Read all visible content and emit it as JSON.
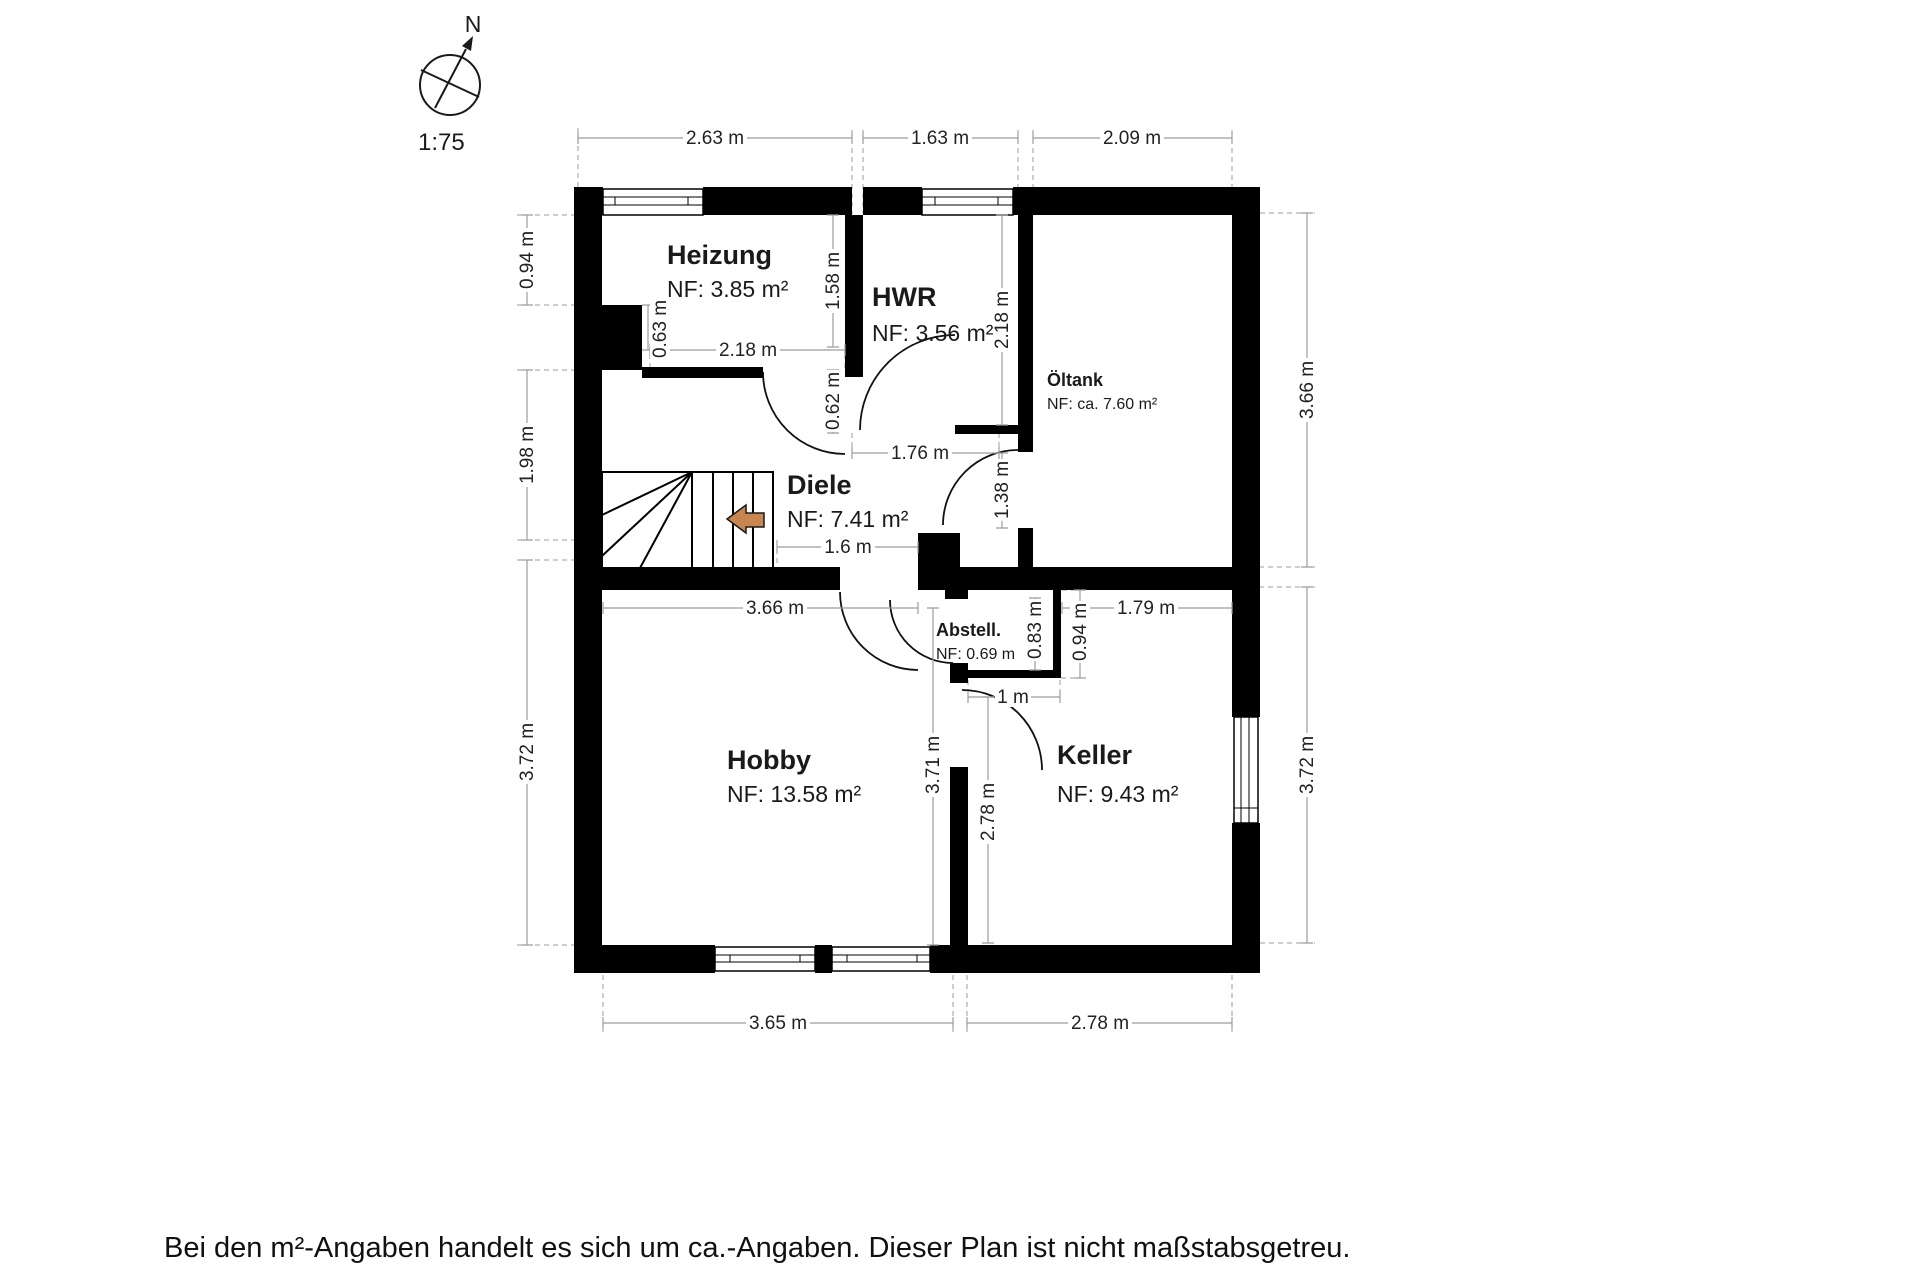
{
  "compass": {
    "north": "N",
    "scale": "1:75"
  },
  "caption": {
    "text": "Bei den m²-Angaben handelt es sich um ca.-Angaben. Dieser Plan ist nicht maßstabsgetreu."
  },
  "rooms": {
    "heizung": {
      "name": "Heizung",
      "area": "NF: 3.85 m²"
    },
    "hwr": {
      "name": "HWR",
      "area": "NF: 3.56 m²"
    },
    "oeltank": {
      "name": "Öltank",
      "area": "NF: ca. 7.60 m²"
    },
    "diele": {
      "name": "Diele",
      "area": "NF: 7.41 m²"
    },
    "abstell": {
      "name": "Abstell.",
      "area": "NF: 0.69 m"
    },
    "hobby": {
      "name": "Hobby",
      "area": "NF: 13.58 m²"
    },
    "keller": {
      "name": "Keller",
      "area": "NF: 9.43 m²"
    }
  },
  "dims": {
    "top": [
      "2.63 m",
      "1.63 m",
      "2.09 m"
    ],
    "left": [
      "0.94 m",
      "1.98 m",
      "3.72 m"
    ],
    "right": [
      "3.66 m",
      "3.72 m"
    ],
    "bottom": [
      "3.65 m",
      "2.78 m"
    ],
    "heizung_width": "2.18 m",
    "heizung_depth": "1.58 m",
    "chimney_depth": "0.63 m",
    "heizung_door_offset": "0.62 m",
    "hwr_depth": "2.18 m",
    "hwr_width": "1.76 m",
    "oeltank_door_width": "1.38 m",
    "diele_opening": "1.6 m",
    "hobby_width": "3.66 m",
    "hobby_depth": "3.71 m",
    "keller_top_width": "1.79 m",
    "abstell_depth": "0.83 m",
    "abstell_outer_depth": "0.94 m",
    "keller_door_width": "1 m",
    "keller_depth": "2.78 m"
  },
  "colors": {
    "wall": "#000000",
    "dimension_line": "#9c9c9c",
    "text": "#1a1a1a",
    "stair_arrow_fill": "#c8854f"
  }
}
